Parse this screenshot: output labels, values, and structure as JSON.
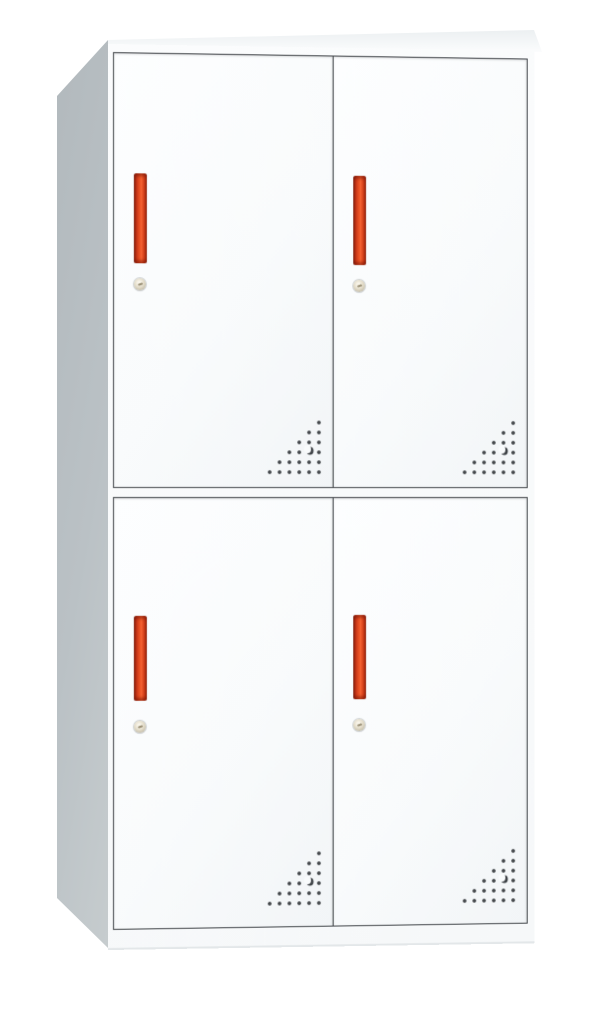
{
  "meta": {
    "description": "Product photo of a white four-door steel locker cabinet (2x2 compartments) with red vertical handles, round cam locks and triangular ventilation perforations",
    "image_type": "product-photograph",
    "text_content": "none"
  },
  "cabinet": {
    "door_count": 4,
    "layout": "2 columns x 2 rows",
    "doors": [
      {
        "id": "top-left",
        "position": "tl",
        "features": [
          "red-bar-handle",
          "cam-lock",
          "vent-perforations"
        ]
      },
      {
        "id": "top-right",
        "position": "tr",
        "features": [
          "red-bar-handle",
          "cam-lock",
          "vent-perforations"
        ]
      },
      {
        "id": "bottom-left",
        "position": "bl",
        "features": [
          "red-bar-handle",
          "cam-lock",
          "vent-perforations"
        ]
      },
      {
        "id": "bottom-right",
        "position": "br",
        "features": [
          "red-bar-handle",
          "cam-lock",
          "vent-perforations"
        ]
      }
    ],
    "feature_descriptions": {
      "red-bar-handle": "vertical red recessed pull handle",
      "cam-lock": "small round keyed cam lock below handle",
      "vent-perforations": "right-triangle grid of punched holes with crescent cutout at bottom corner of each door"
    }
  },
  "colors": {
    "background": "#ffffff",
    "cabinet_body": "#fbfcfd",
    "side_panel": "#bac1c5",
    "side_panel_dark": "#b2b9bd",
    "door_face": "#f9fbfc",
    "door_border": "#43474b",
    "handle_red": "#ee5527",
    "handle_red_dark": "#8e2412",
    "handle_red_bright": "#f26030",
    "lock_brass": "#e4ddca",
    "vent_hole": "#43474a"
  }
}
